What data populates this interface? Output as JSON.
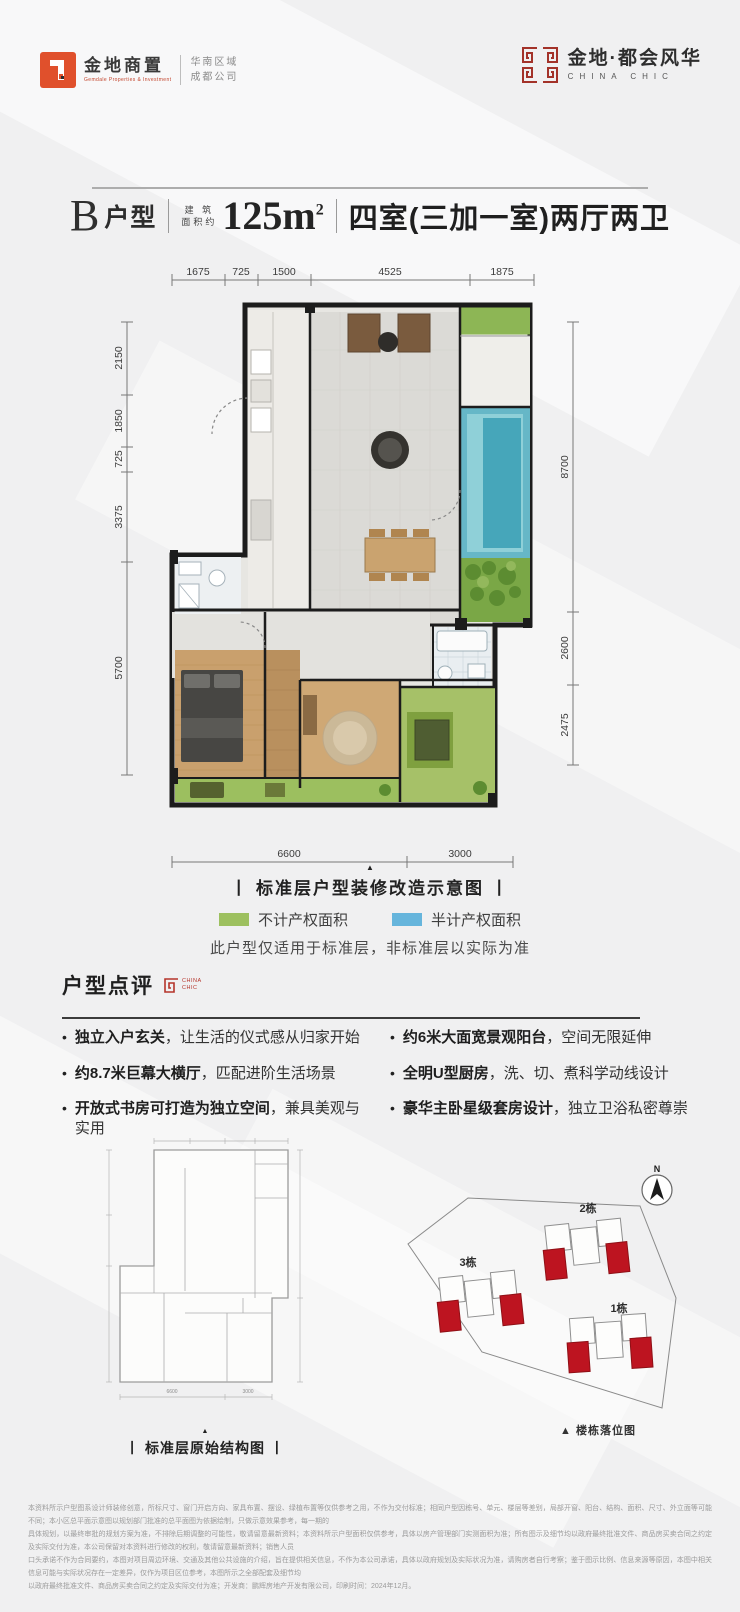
{
  "colors": {
    "accent_red": "#b5342a",
    "building_red": "#bd1420",
    "legend_green": "#9dc05f",
    "legend_blue": "#66b5dc",
    "wall_black": "#1c1c1c",
    "background": "#f0f0f1"
  },
  "header": {
    "left_logo": {
      "name": "金地商置",
      "sub": "Gemdale Properties & Investment",
      "region_line1": "华南区域",
      "region_line2": "成都公司"
    },
    "right_logo": {
      "name": "金地·都会风华",
      "sub": "CHINA CHIC"
    }
  },
  "title": {
    "unit": "B",
    "unit_suffix": "户型",
    "area_label_line1": "建 筑",
    "area_label_line2": "面积约",
    "area_value": "125m",
    "area_sup": "2",
    "rooms": "四室(三加一室)两厅两卫"
  },
  "floor_plan": {
    "dims_top": [
      "1675",
      "725",
      "1500",
      "4525",
      "1875"
    ],
    "dims_left": [
      "2150",
      "1850",
      "725",
      "3375",
      "5700"
    ],
    "dims_right": [
      "8700",
      "2600",
      "2475"
    ],
    "dims_bottom": [
      "6600",
      "3000"
    ],
    "marker": "▲",
    "caption": "丨 标准层户型装修改造示意图 丨",
    "legend": [
      {
        "label": "不计产权面积",
        "color": "#9dc05f"
      },
      {
        "label": "半计产权面积",
        "color": "#66b5dc"
      }
    ],
    "note": "此户型仅适用于标准层，非标准层以实际为准"
  },
  "review": {
    "title": "户型点评",
    "logo_line1": "CHINA",
    "logo_line2": "CHIC",
    "bullet_char": "•",
    "bullets_left": [
      {
        "bold": "独立入户玄关",
        "rest": "，让生活的仪式感从归家开始"
      },
      {
        "bold": "约8.7米巨幕大横厅",
        "rest": "，匹配进阶生活场景"
      },
      {
        "bold": "开放式书房可打造为独立空间",
        "rest": "，兼具美观与实用"
      }
    ],
    "bullets_right": [
      {
        "bold": "约6米大面宽景观阳台",
        "rest": "，空间无限延伸"
      },
      {
        "bold": "全明U型厨房",
        "rest": "，洗、切、煮科学动线设计"
      },
      {
        "bold": "豪华主卧星级套房设计",
        "rest": "，独立卫浴私密尊崇"
      }
    ]
  },
  "structure_diagram": {
    "marker": "▲",
    "caption": "丨 标准层原始结构图 丨"
  },
  "site_plan": {
    "buildings": [
      "2栋",
      "3栋",
      "1栋"
    ],
    "compass_label": "N",
    "caption": "▲ 楼栋落位图"
  },
  "disclaimer": {
    "line1": "本资料所示户型图系设计师装修创意，所标尺寸、窗门开启方向、家具布置、摆设、绿植布置等仅供参考之用，不作为交付标准；相同户型因栋号、单元、楼层等差别，局部开窗、阳台、结构、面积、尺寸、外立面等可能不同；本小区总平面示意图以规划部门批准的总平面图为依据绘制，只做示意效果参考，每一期的",
    "line2": "具体规划，以最终审批的规划方案为准，不排除后期调整的可能性，敬请留意最新资料；本资料所示户型面积仅供参考，具体以房产管理部门实测面积为准；所有图示及细节均以政府最终批准文件、商品房买卖合同之约定及实际交付为准，本公司保留对本资料进行修改的权利，敬请留意最新资料；销售人员",
    "line3": "口头承诺不作为合同要约，本图对项目周边环境、交通及其他公共设施的介绍，旨在提供相关信息，不作为本公司承诺，具体以政府规划及实际状况为准，请购房者自行考察；鉴于图示比例、信息来源等原因，本图中相关信息可能与实际状况存在一定差异，仅作为项目区位参考，本图所示之全部配套及细节均",
    "line4": "以政府最终批准文件、商品房买卖合同之约定及实际交付为准；开发商：鹏辉房地产开发有限公司，印刷时间：2024年12月。"
  }
}
